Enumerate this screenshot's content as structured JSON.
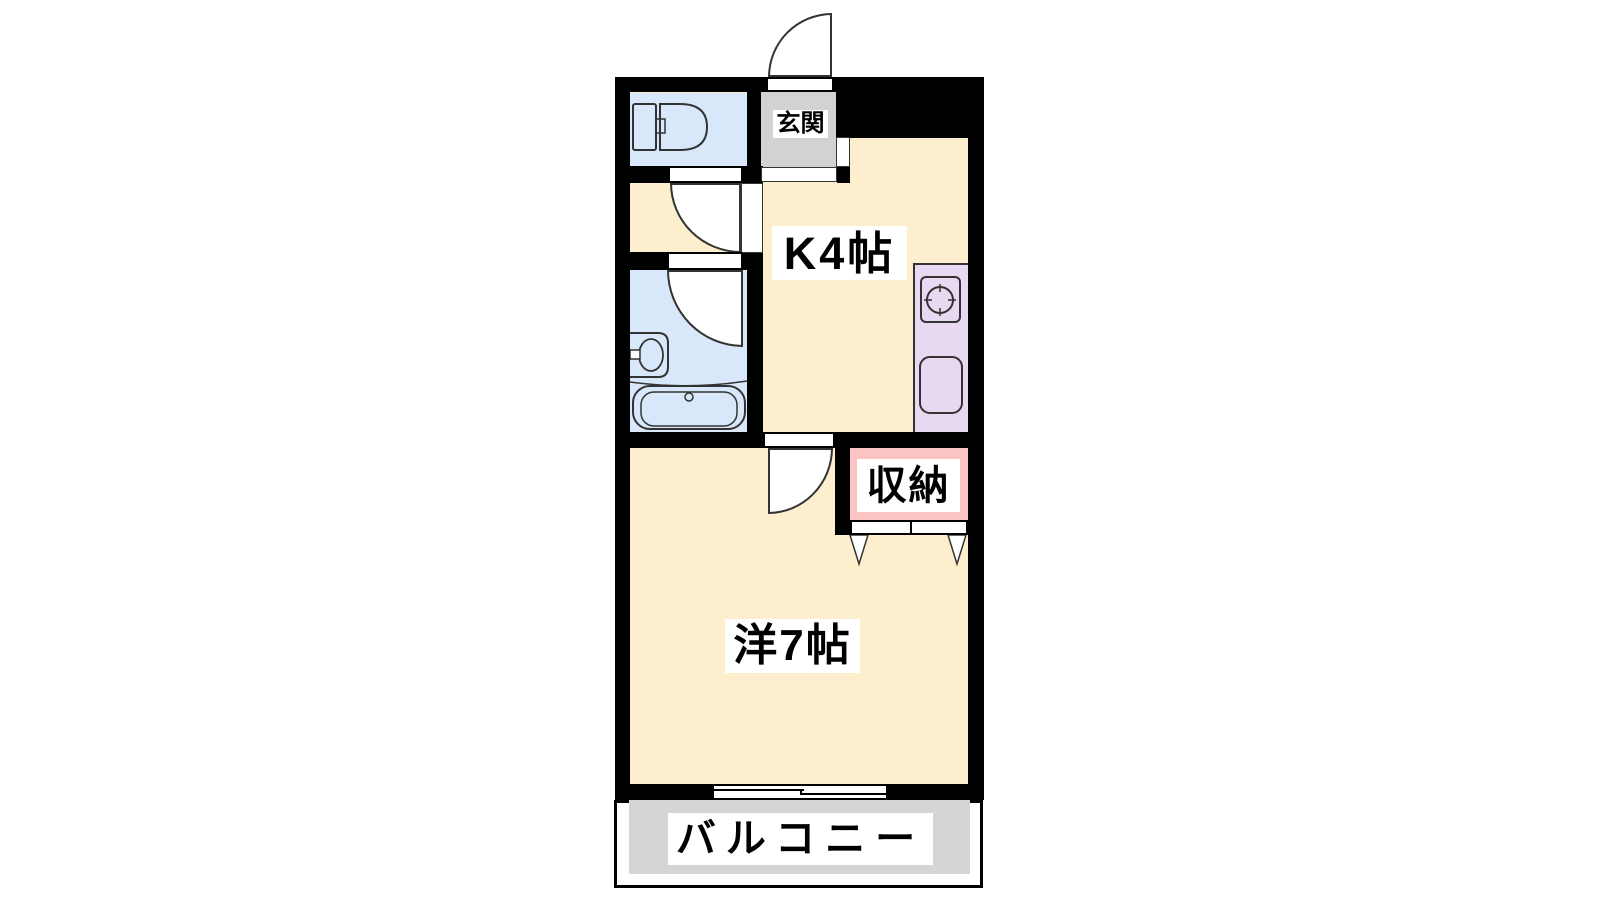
{
  "floorplan": {
    "type": "japanese-apartment-1K",
    "rooms": {
      "entrance": {
        "label": "玄関"
      },
      "kitchen": {
        "label": "K4帖"
      },
      "western": {
        "label": "洋7帖"
      },
      "closet": {
        "label": "収納"
      },
      "balcony": {
        "label": "バルコニー"
      },
      "toilet": {
        "label": ""
      },
      "bathroom": {
        "label": ""
      }
    },
    "fixtures": [
      "toilet-icon",
      "washbasin-icon",
      "bathtub-icon",
      "stove-icon",
      "kitchen-sink-icon",
      "sliding-window-icon",
      "closet-folding-door-arrows",
      "entrance-door-arc",
      "toilet-door-arc",
      "bathroom-door-arc",
      "western-room-door-arc"
    ],
    "colors": {
      "wall": "#000000",
      "floor_cream": "#FDEECD",
      "water_blue": "#D8E8FA",
      "entrance_gray": "#D2D2D2",
      "counter_lavender": "#E6D9F1",
      "closet_pink": "#FBC3C3",
      "balcony_gray": "#D5D5D5",
      "outline": "#333333"
    }
  }
}
